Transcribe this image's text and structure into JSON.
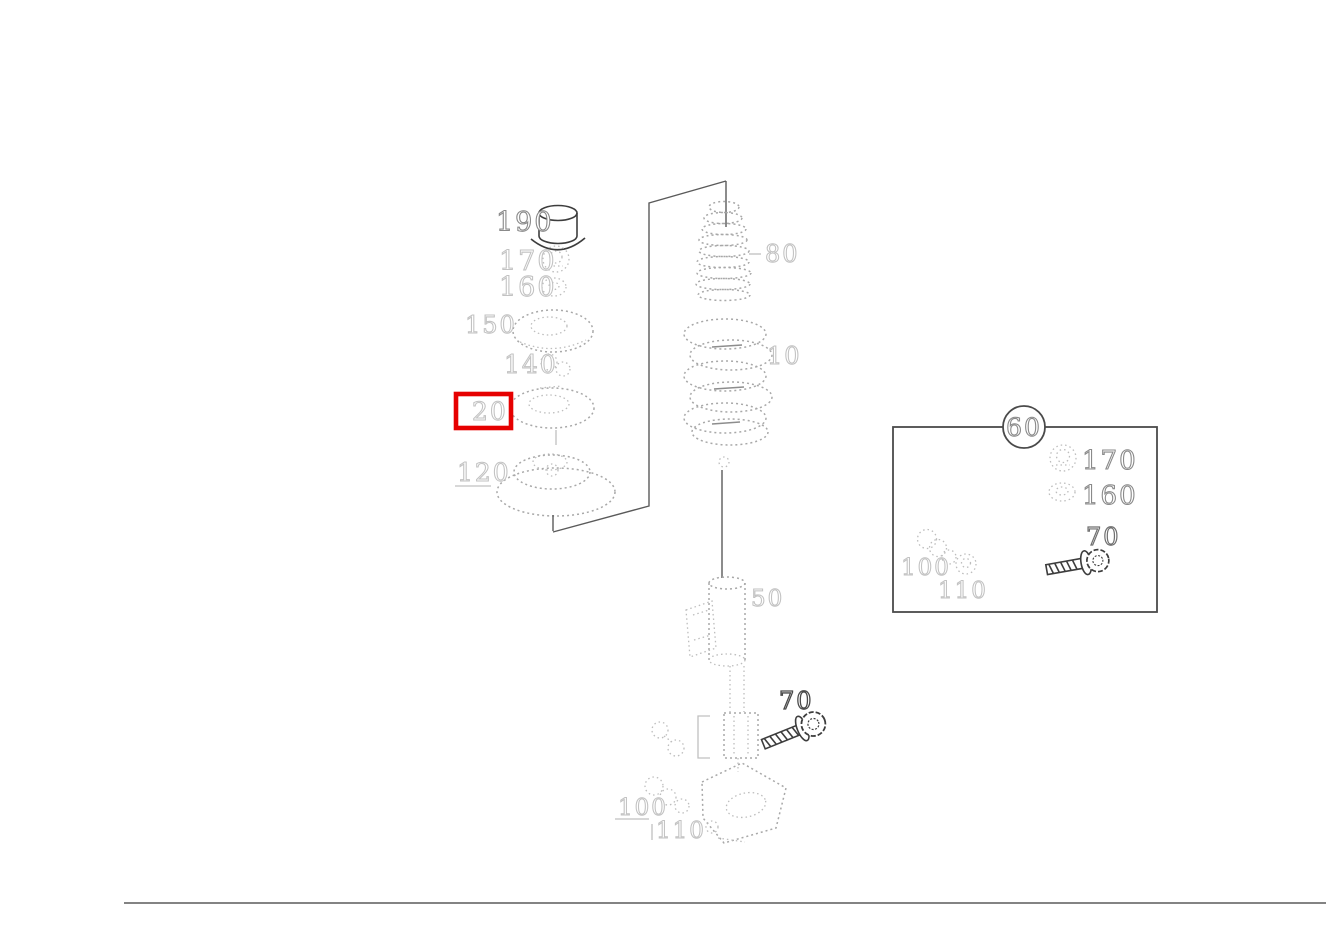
{
  "colors": {
    "highlight": "#e60000",
    "line_art_dark": "#3d3d3d",
    "line_art_faint": "#c2c2c2",
    "footer_rule": "#555555"
  },
  "callouts": {
    "cap": "190",
    "nut": "170",
    "washer": "160",
    "mount": "150",
    "bearing": "140",
    "pad_selected": "20",
    "seat": "120",
    "boot": "80",
    "spring": "10",
    "strut": "50",
    "bolt": "70",
    "stack": "100",
    "fork": "110"
  },
  "inset": {
    "group": "60",
    "nut": "170",
    "washer": "160",
    "bolt": "70",
    "stack": "100",
    "locknut": "110"
  }
}
